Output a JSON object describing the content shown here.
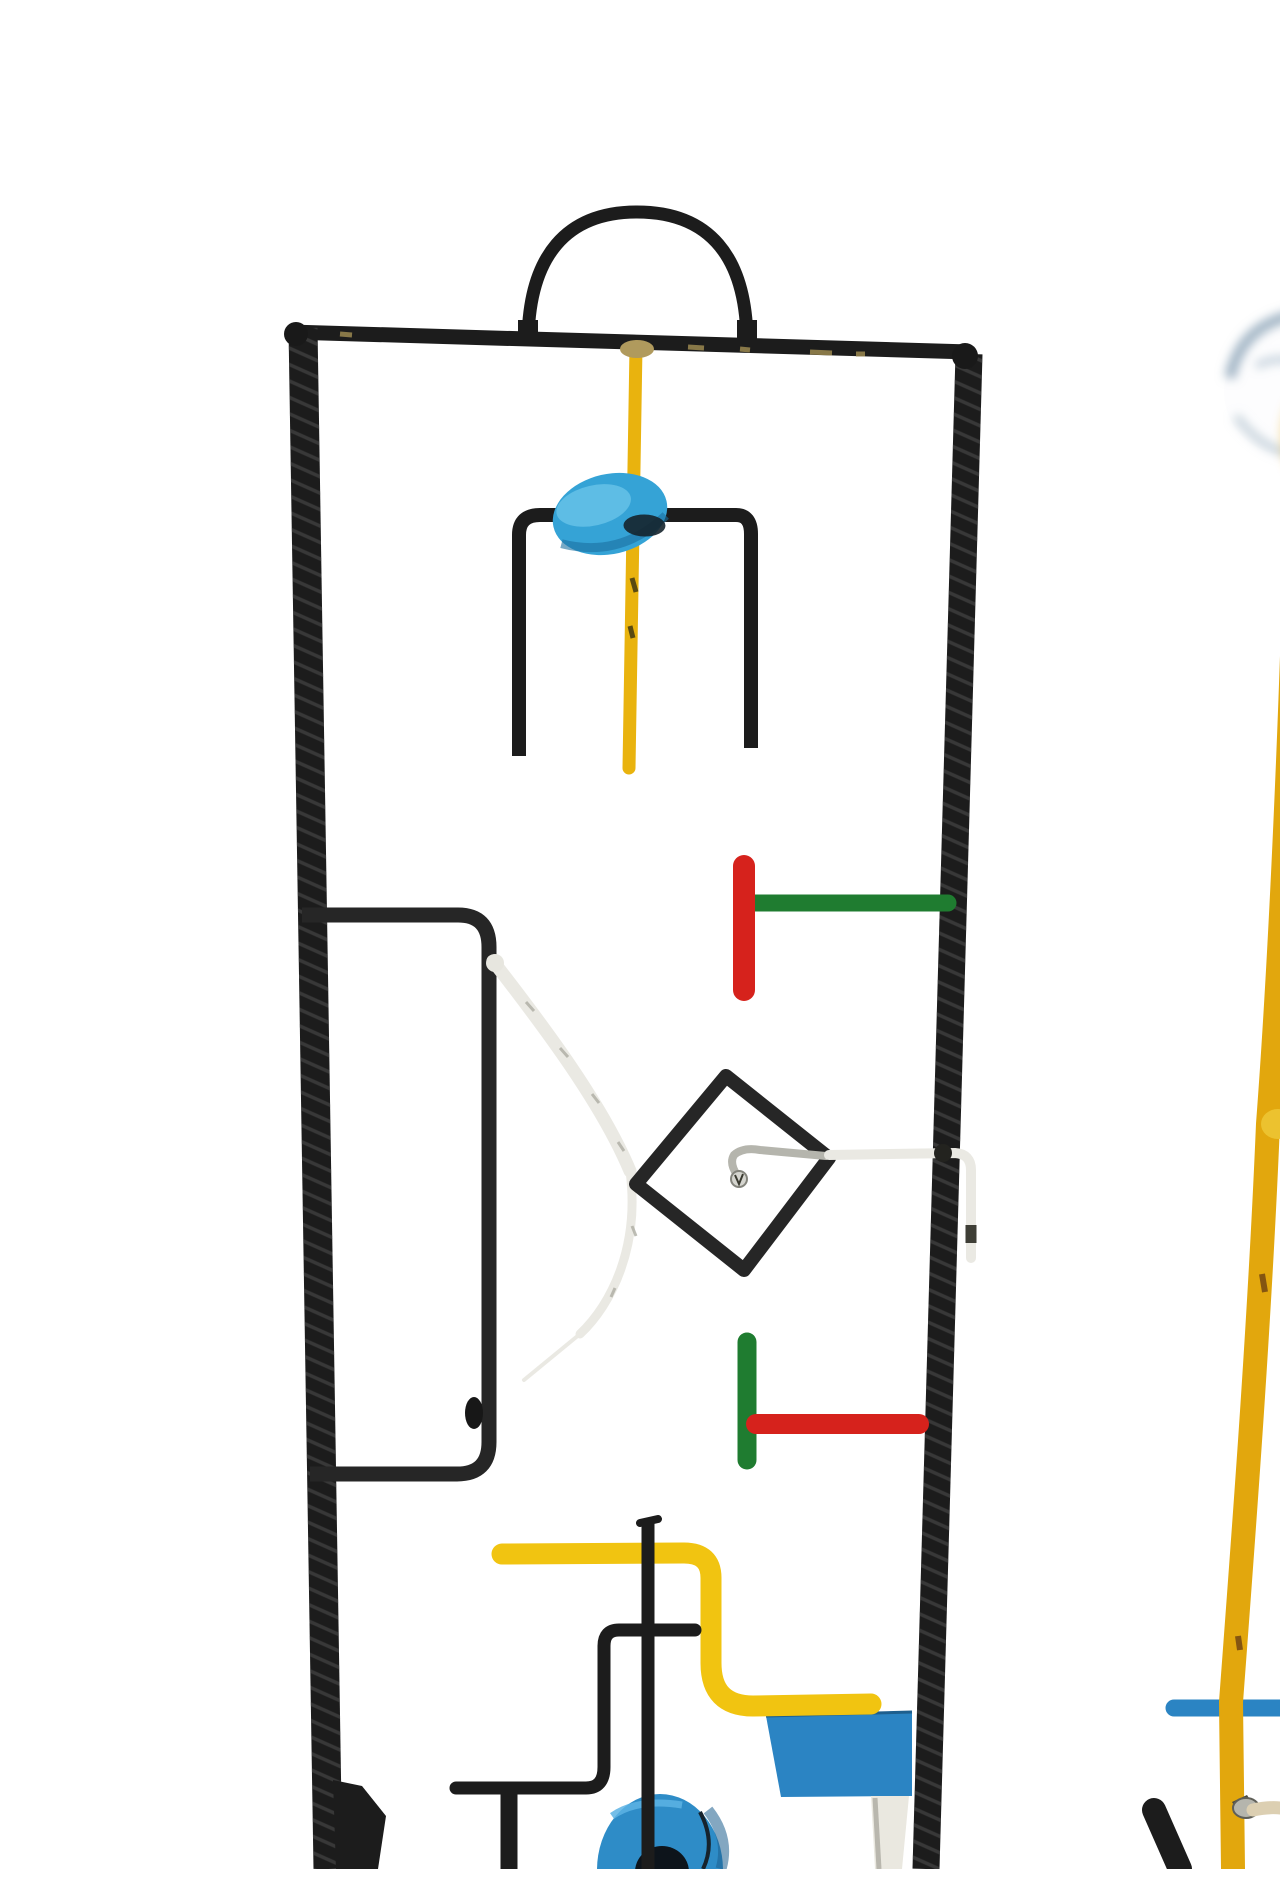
{
  "image": {
    "subject": "Abstract welded-metal wire sculpture, painted in primary colors, photographed on a seamless white background",
    "style": "mid-century modernist / Calder-like assemblage",
    "background_color": "#ffffff"
  },
  "palette": {
    "frame_black": "#1c1c1c",
    "soft_black": "#262626",
    "rebar_ridge": "#4d4d4d",
    "yellow": "#e9b30e",
    "yellow_tube": "#f1c411",
    "yellow_right": "#e2a70d",
    "yellow_glow": "#f2cf6e",
    "sky_blue": "#35a3d6",
    "sky_blue_light": "#6cc6e9",
    "sky_blue_dark": "#1a6fa0",
    "blue": "#2b84c3",
    "blue_donut": "#2e8cc7",
    "donut_hole": "#0d141b",
    "red": "#d6221c",
    "green": "#1f7c30",
    "white_wire": "#eae9e3",
    "wire_shadow": "#3e3e36",
    "cream_wire": "#dccfb2",
    "gray_metal": "#b5b5ad",
    "screw_gray": "#d5d5cf",
    "khaki_weld": "#b09a5d",
    "paint_chip": "#94824d",
    "glass_rim": "#8ea6b8",
    "glass_rim_light": "#b8c7d2",
    "dark_olive": "#35372a",
    "post_white": "#eae8e0",
    "panel_seam": "#1e5f8e"
  },
  "parts": {
    "frame": "black rebar rectangular frame, open at bottom",
    "handle": "black arched carry handle on top bar",
    "spindle": "yellow vertical rod with sky-blue wooden disc and black fork",
    "upper_t": "red vertical + green horizontal T element",
    "inner_loop": "black rounded C-shaped loop on left side",
    "white_bow": "white twisted-wire bow holding a tilted black diamond",
    "diamond": "black open diamond (rotated square) with gray hook and screw",
    "lower_t": "green vertical + red horizontal T element",
    "bottom_cluster": "yellow S-tube, black Z-bar, thin black rod, blue panel, blue donut ring, white post",
    "right_piece": "second sculpture: glass sphere on leaning yellow rod with blue crossbar, cream wire and black foot"
  }
}
